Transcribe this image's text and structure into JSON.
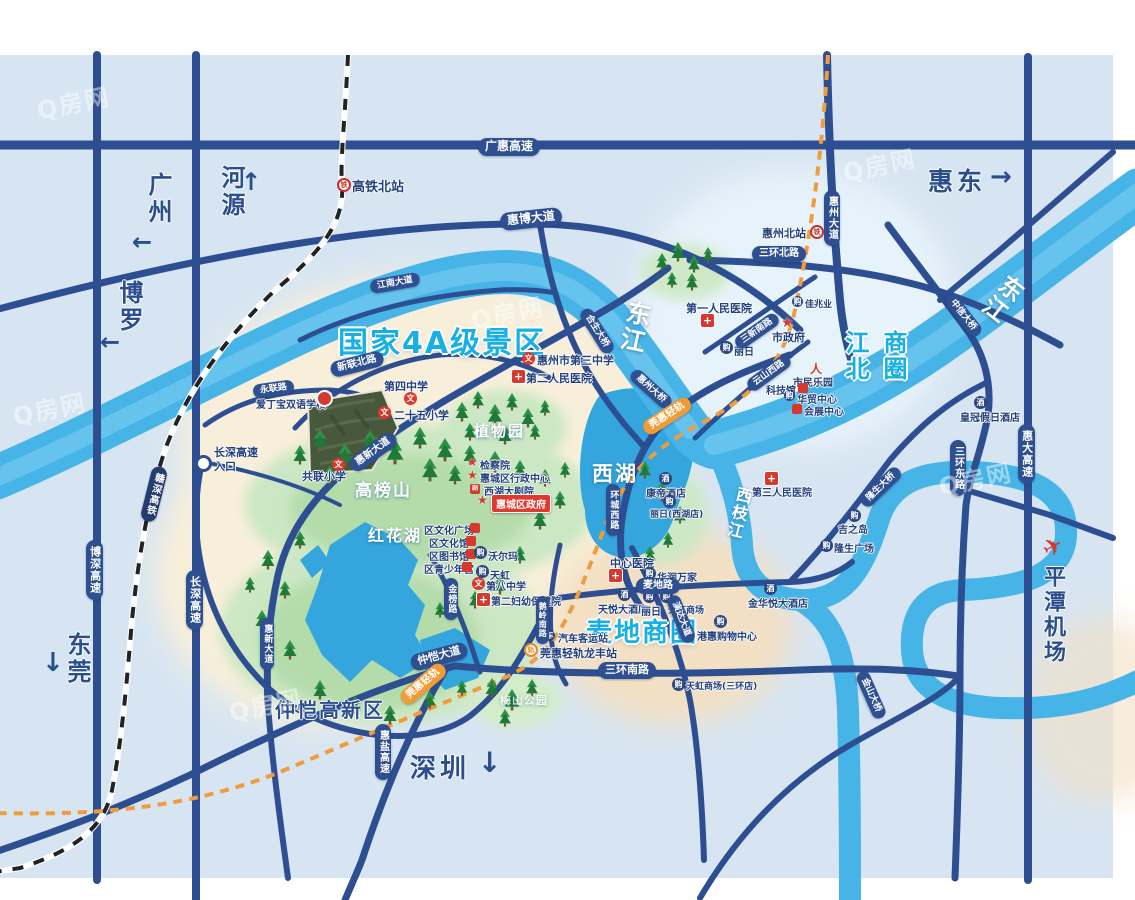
{
  "watermark": "Q房网",
  "regions": {
    "scenic_area": "国家4A级景区",
    "jiangbei_col1": "江北",
    "jiangbei_col2": "商圈",
    "maidi": "麦地商圈",
    "zhongkai": "仲恺高新区"
  },
  "nav": {
    "guangzhou": "广州",
    "heyuan": "河源",
    "boluo": "博罗",
    "dongguan": "东莞",
    "huidong": "惠东",
    "shenzhen": "深圳",
    "pingtan_airport": "平潭机场"
  },
  "waters": {
    "dongjiang": "东江",
    "xizhijiang": "西枝江",
    "xihu": "西湖",
    "honghuahu": "红花湖"
  },
  "nature": {
    "gaobangshan": "高榜山",
    "botanical_garden": "植物园",
    "meishan_park": "梅山公园"
  },
  "roads": {
    "guanghui_expwy": "广惠高速",
    "huibo_ave": "惠博大道",
    "jiangnan_ave": "江南大道",
    "sanhuan_north": "三环北路",
    "huizhou_ave": "惠州大道",
    "xinlian_north": "新联北路",
    "yonglian_rd": "永联路",
    "huixin_ave": "惠新大道",
    "hesheng_bridge": "合生大桥",
    "huizhou_bridge": "惠州大桥",
    "zhongxin_bridge": "中信大桥",
    "longsheng_bridge": "隆生大桥",
    "jinshan_bridge": "金山大桥",
    "yunshan_west": "云山西路",
    "sanxin_south": "三新南路",
    "huancheng_west": "环城西路",
    "maidi_rd": "麦地路",
    "yanda_ave": "演达大道",
    "jinbang_rd": "金榜路",
    "eling_south": "鹅岭南路",
    "sanhuan_south": "三环南路",
    "zhongkai_ave": "仲恺大道",
    "sanhuan_east": "三环东路",
    "huida_expwy": "惠大高速",
    "huiyan_expwy": "惠盐高速",
    "boshen_expwy": "博深高速",
    "changshen_expwy": "长深高速",
    "ganshen_hsr": "赣深高铁",
    "wanhui_rail": "莞惠轻轨",
    "entrance_line1": "长深高速",
    "entrance_line2": "入口"
  },
  "stations": {
    "gaotie_north": "高铁北站",
    "huizhou_north": "惠州北站",
    "longfeng": "莞惠轻轨龙丰站",
    "bus_station": "汽车客运站"
  },
  "pois": {
    "aidingbao_school": "爱丁宝双语学校",
    "no4_middle": "第四中学",
    "no25_primary": "二十五小学",
    "gonglian_primary": "共联小学",
    "no3_middle": "惠州市第三中学",
    "no8_middle": "第八中学",
    "no2_hospital": "第二人民医院",
    "no1_hospital": "第一人民医院",
    "no3_hospital": "第三人民医院",
    "center_hospital": "中心医院",
    "fuyou_hospital": "第二妇幼保健院",
    "procuratorate": "检察院",
    "district_admin": "惠城区行政中心",
    "district_gov": "惠城区政府",
    "city_gov": "市政府",
    "xihu_theater": "西湖大剧院",
    "culture_square": "区文化广场",
    "culture_center": "区文化馆",
    "library": "区图书馆",
    "youth_palace": "区青少年宫",
    "walmart": "沃尔玛",
    "tianhong": "天虹",
    "liri": "丽日",
    "liri_xihu": "丽日(西湖店)",
    "kangdi_hotel": "康帝酒店",
    "tianyue_hotel": "天悦大酒店",
    "tianhong_mall": "天虹商场",
    "tianhong_sanhuan": "天虹商场(三环店)",
    "huarun": "华润万家",
    "ganghui": "港惠购物中心",
    "jinhuayue_hotel": "金华悦大酒店",
    "longsheng_plaza": "隆生广场",
    "jizhidao": "吉之岛",
    "jiazhaoye": "佳兆业",
    "huamao_center": "华贸中心",
    "exhibition_center": "会展中心",
    "science_museum": "科技馆",
    "citizen_park": "市民乐园",
    "crowne_plaza": "皇冠假日酒店"
  },
  "icons": {
    "school": "文",
    "hospital": "+",
    "star": "★",
    "mall": "购",
    "hotel": "酒",
    "rail": "铁",
    "light_rail": "轨",
    "bus": "车",
    "theater": "剧",
    "person": "人",
    "plane": "✈",
    "arrow_left": "←",
    "arrow_right": "→",
    "arrow_up": "↑",
    "arrow_down": "↓"
  }
}
